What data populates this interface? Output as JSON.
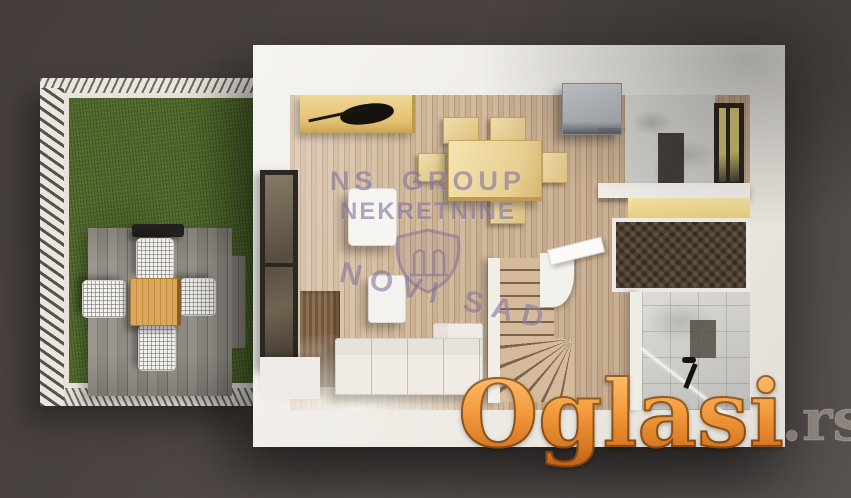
{
  "image_type": "3d-floor-plan-render",
  "canvas": {
    "width_px": 851,
    "height_px": 498,
    "background_color": "#4a4340"
  },
  "watermarks": {
    "agency": {
      "line1": "NS GROUP",
      "line2": "NEKRETNINE",
      "city": "NOVI SAD",
      "emblem_icon": "shield-crest-icon",
      "color": "#796a96"
    },
    "site": {
      "name": "Oglasi",
      "tld": ".rs",
      "gradient_top": "#fdc272",
      "gradient_bottom": "#bf641a",
      "outline_color": "#522908",
      "tld_color": "#d2c4b5"
    }
  },
  "scene": {
    "outdoor_elements": [
      "fenced-garden",
      "grass-lawn",
      "wood-deck",
      "grill",
      "outdoor-dining-table",
      "four-wicker-chairs"
    ],
    "indoor_elements": [
      "kitchen-counter-with-cooktop",
      "dining-table-with-chairs",
      "fridge",
      "marble-wall",
      "right-window",
      "shelf-partition",
      "herringbone-wardrobe-nook",
      "bathroom-with-shower",
      "winder-staircase",
      "armchair",
      "pouf",
      "l-shaped-sofa",
      "left-window"
    ]
  }
}
